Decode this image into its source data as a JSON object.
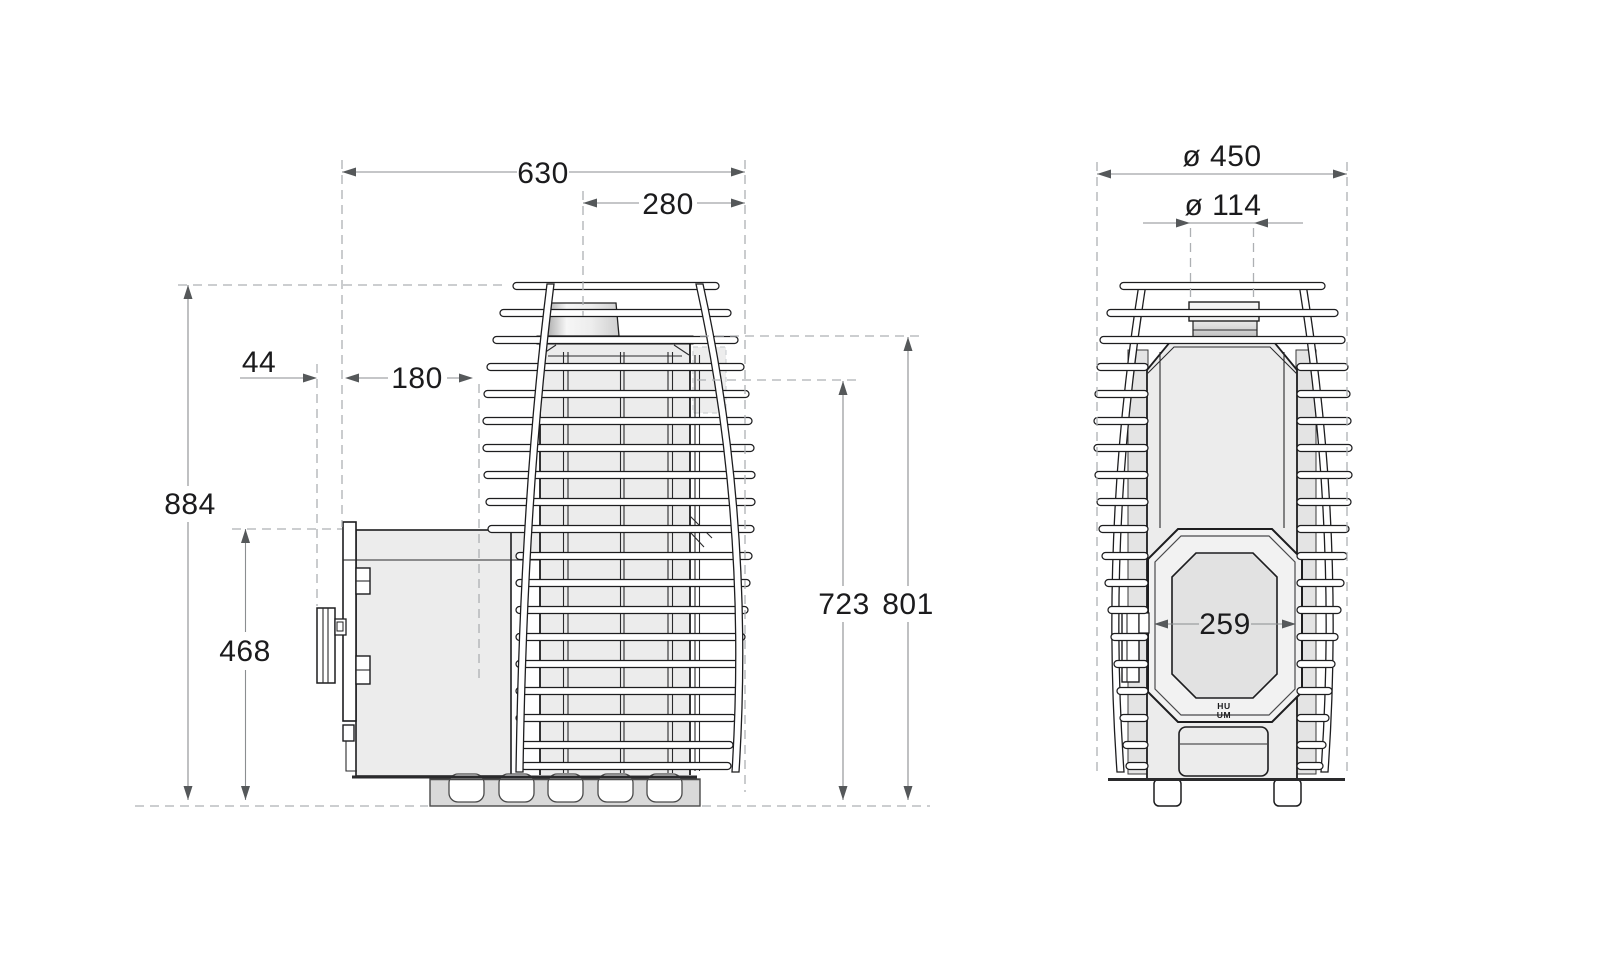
{
  "drawing": {
    "side_view": {
      "label": "stove-side-view",
      "dims": {
        "width_total": "630",
        "width_center_to_edge": "280",
        "depth_handle": "44",
        "depth_front_section": "180",
        "height_total": "884",
        "height_firebox": "468",
        "height_flue_rear": "723",
        "height_body_top": "801"
      }
    },
    "front_view": {
      "label": "stove-front-view",
      "dims": {
        "diameter_body": "ø 450",
        "diameter_chimney": "ø 114",
        "door_glass_width": "259"
      },
      "logo_line1": "HU",
      "logo_line2": "UM"
    },
    "colors": {
      "outline": "#1d1d1f",
      "dimension_line": "#8b8e90",
      "extension_dash": "#adb0b3",
      "body_fill": "#ececec",
      "base_fill": "#d9d9d9",
      "arrow": "#55585a"
    }
  }
}
